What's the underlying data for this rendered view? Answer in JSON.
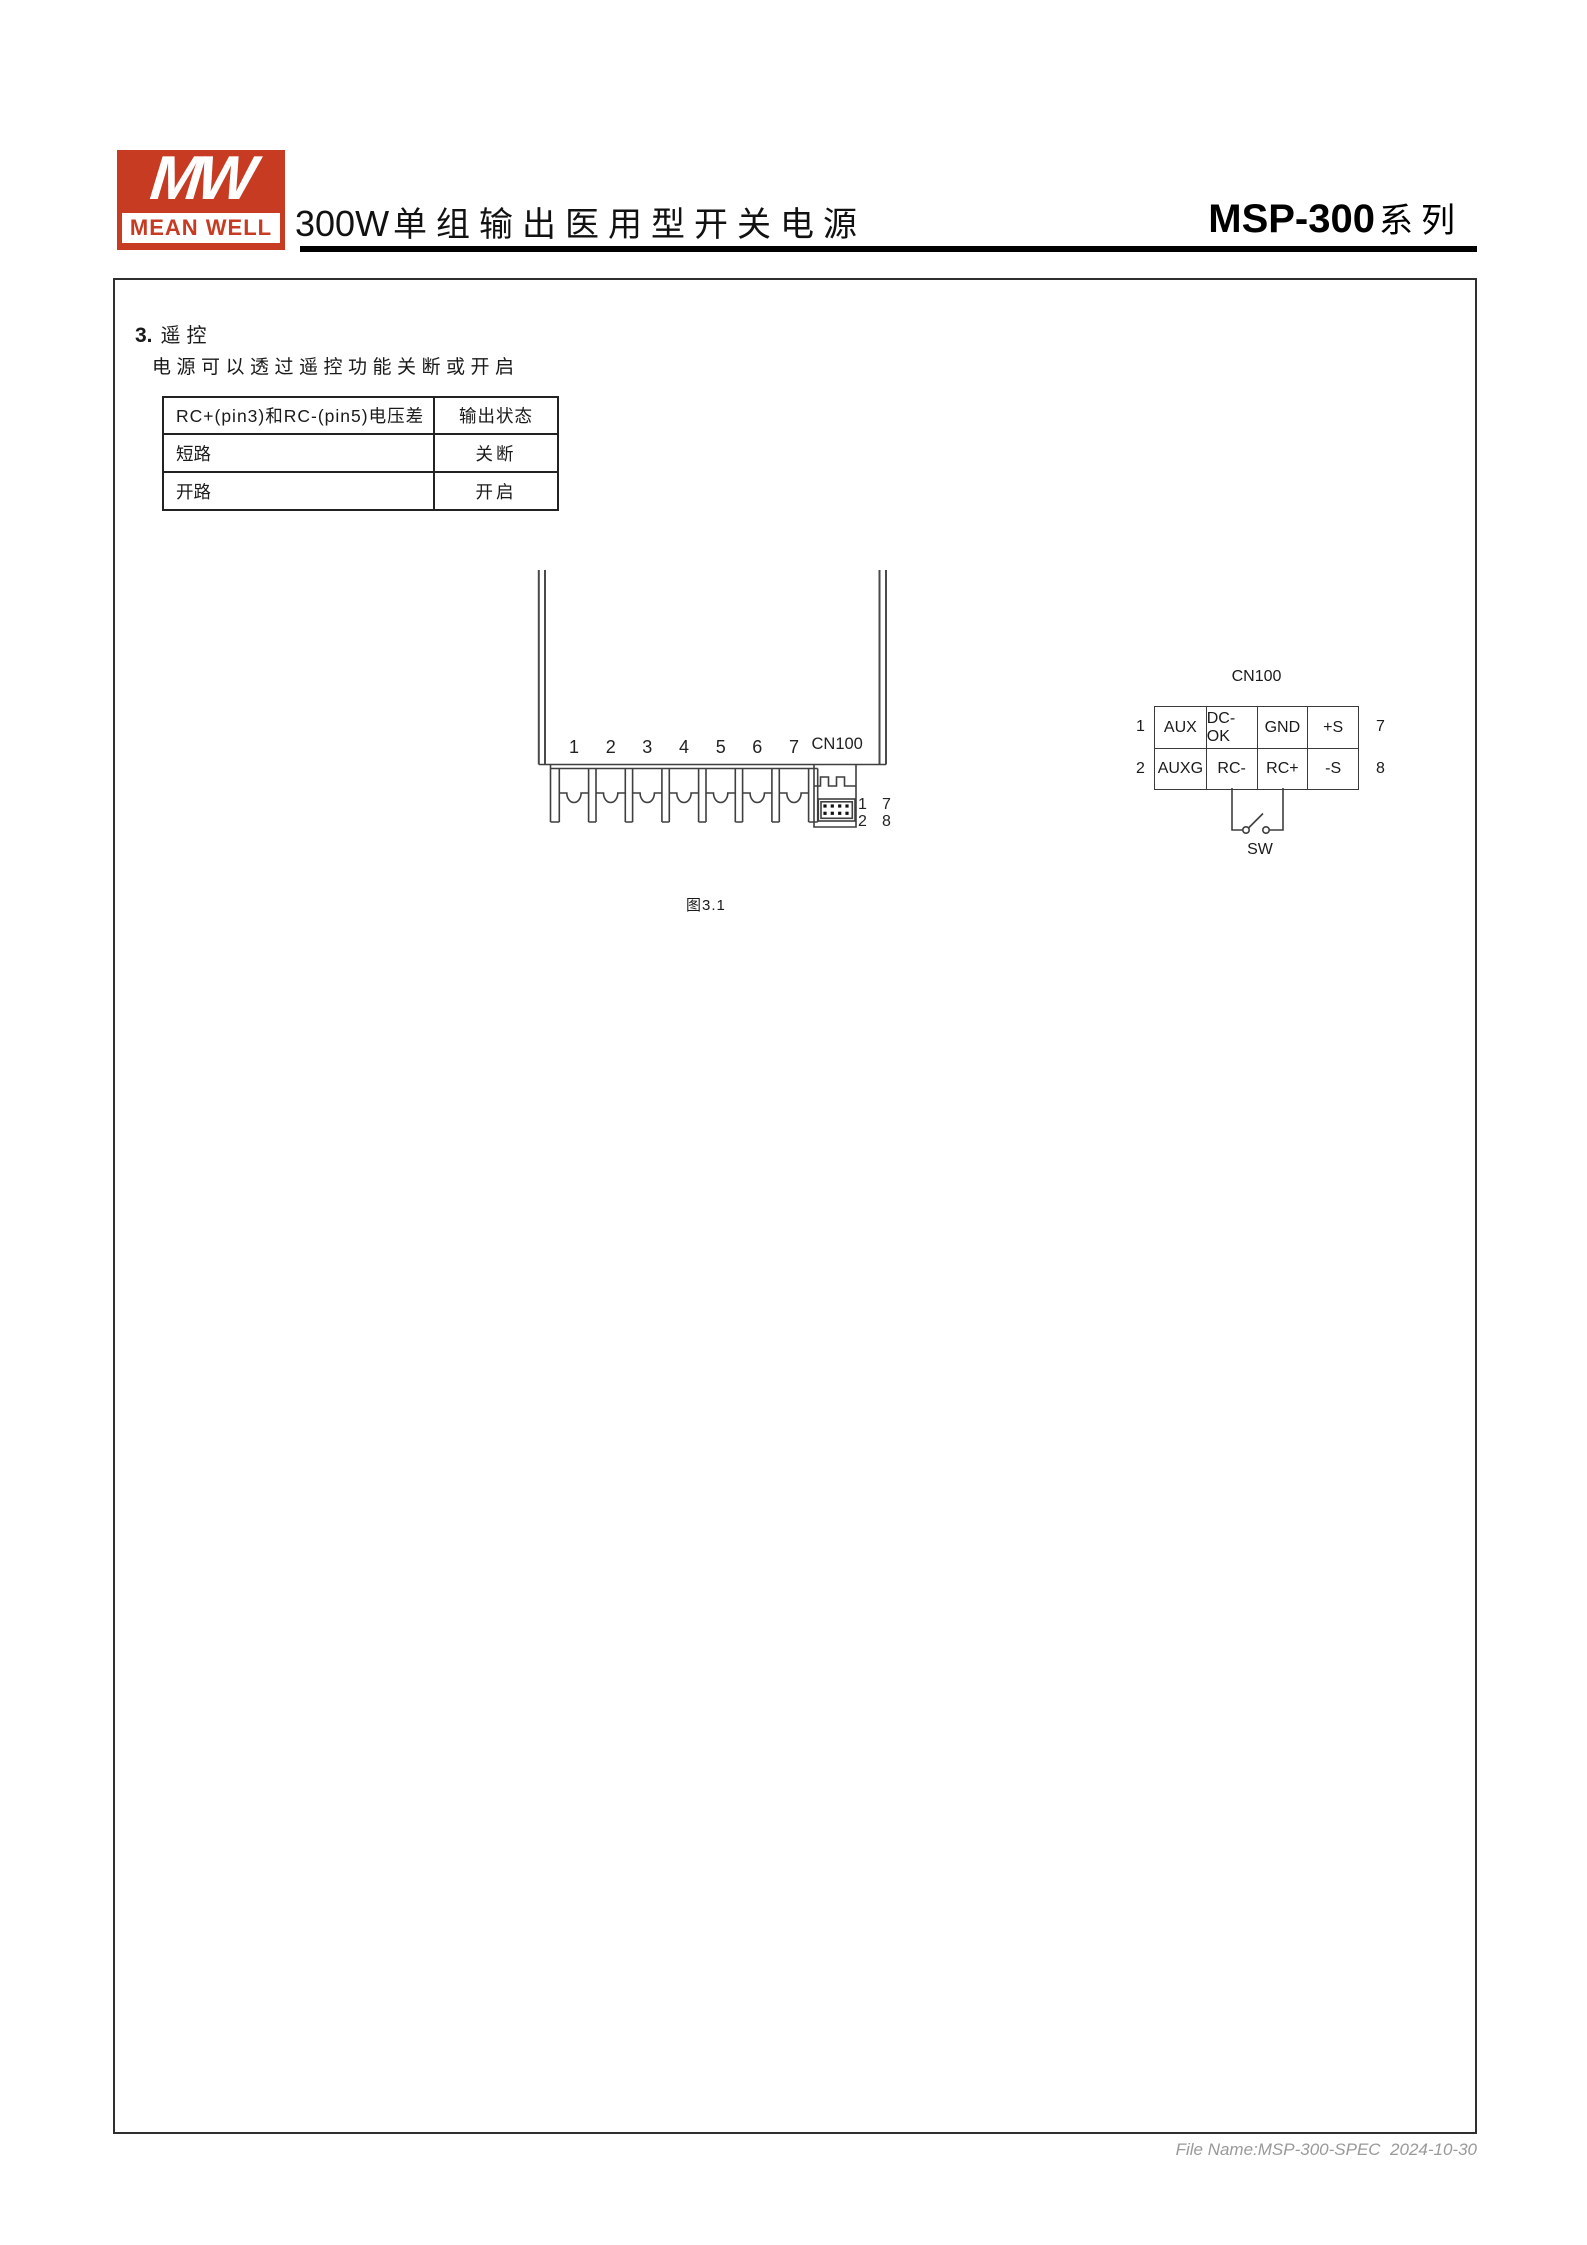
{
  "header": {
    "logo_mark": "MW",
    "logo_name": "MEAN WELL",
    "title_latin": "300W",
    "title_cjk": "单组输出医用型开关电源",
    "series_model": "MSP-300",
    "series_cjk": "系列"
  },
  "section": {
    "number": "3.",
    "title": "遥控",
    "description": "电源可以透过遥控功能关断或开启"
  },
  "remote_table": {
    "headers": [
      "RC+(pin3)和RC-(pin5)电压差",
      "输出状态"
    ],
    "rows": [
      [
        "短路",
        "关断"
      ],
      [
        "开路",
        "开启"
      ]
    ]
  },
  "figure": {
    "terminal_numbers": [
      "1",
      "2",
      "3",
      "4",
      "5",
      "6",
      "7"
    ],
    "connector_label": "CN100",
    "pin_labels": {
      "top_left": "1",
      "top_right": "7",
      "bottom_left": "2",
      "bottom_right": "8"
    },
    "caption": "图3.1"
  },
  "cn100": {
    "title": "CN100",
    "left_pins": [
      "1",
      "2"
    ],
    "right_pins": [
      "7",
      "8"
    ],
    "rows": [
      [
        "AUX",
        "DC-OK",
        "GND",
        "+S"
      ],
      [
        "AUXG",
        "RC-",
        "RC+",
        "-S"
      ]
    ],
    "switch_label": "SW"
  },
  "footer": {
    "file_info": "File Name:MSP-300-SPEC  2024-10-30"
  },
  "colors": {
    "brand_red": "#C63B21",
    "line": "#3f3f3f",
    "footer_gray": "#999999"
  }
}
